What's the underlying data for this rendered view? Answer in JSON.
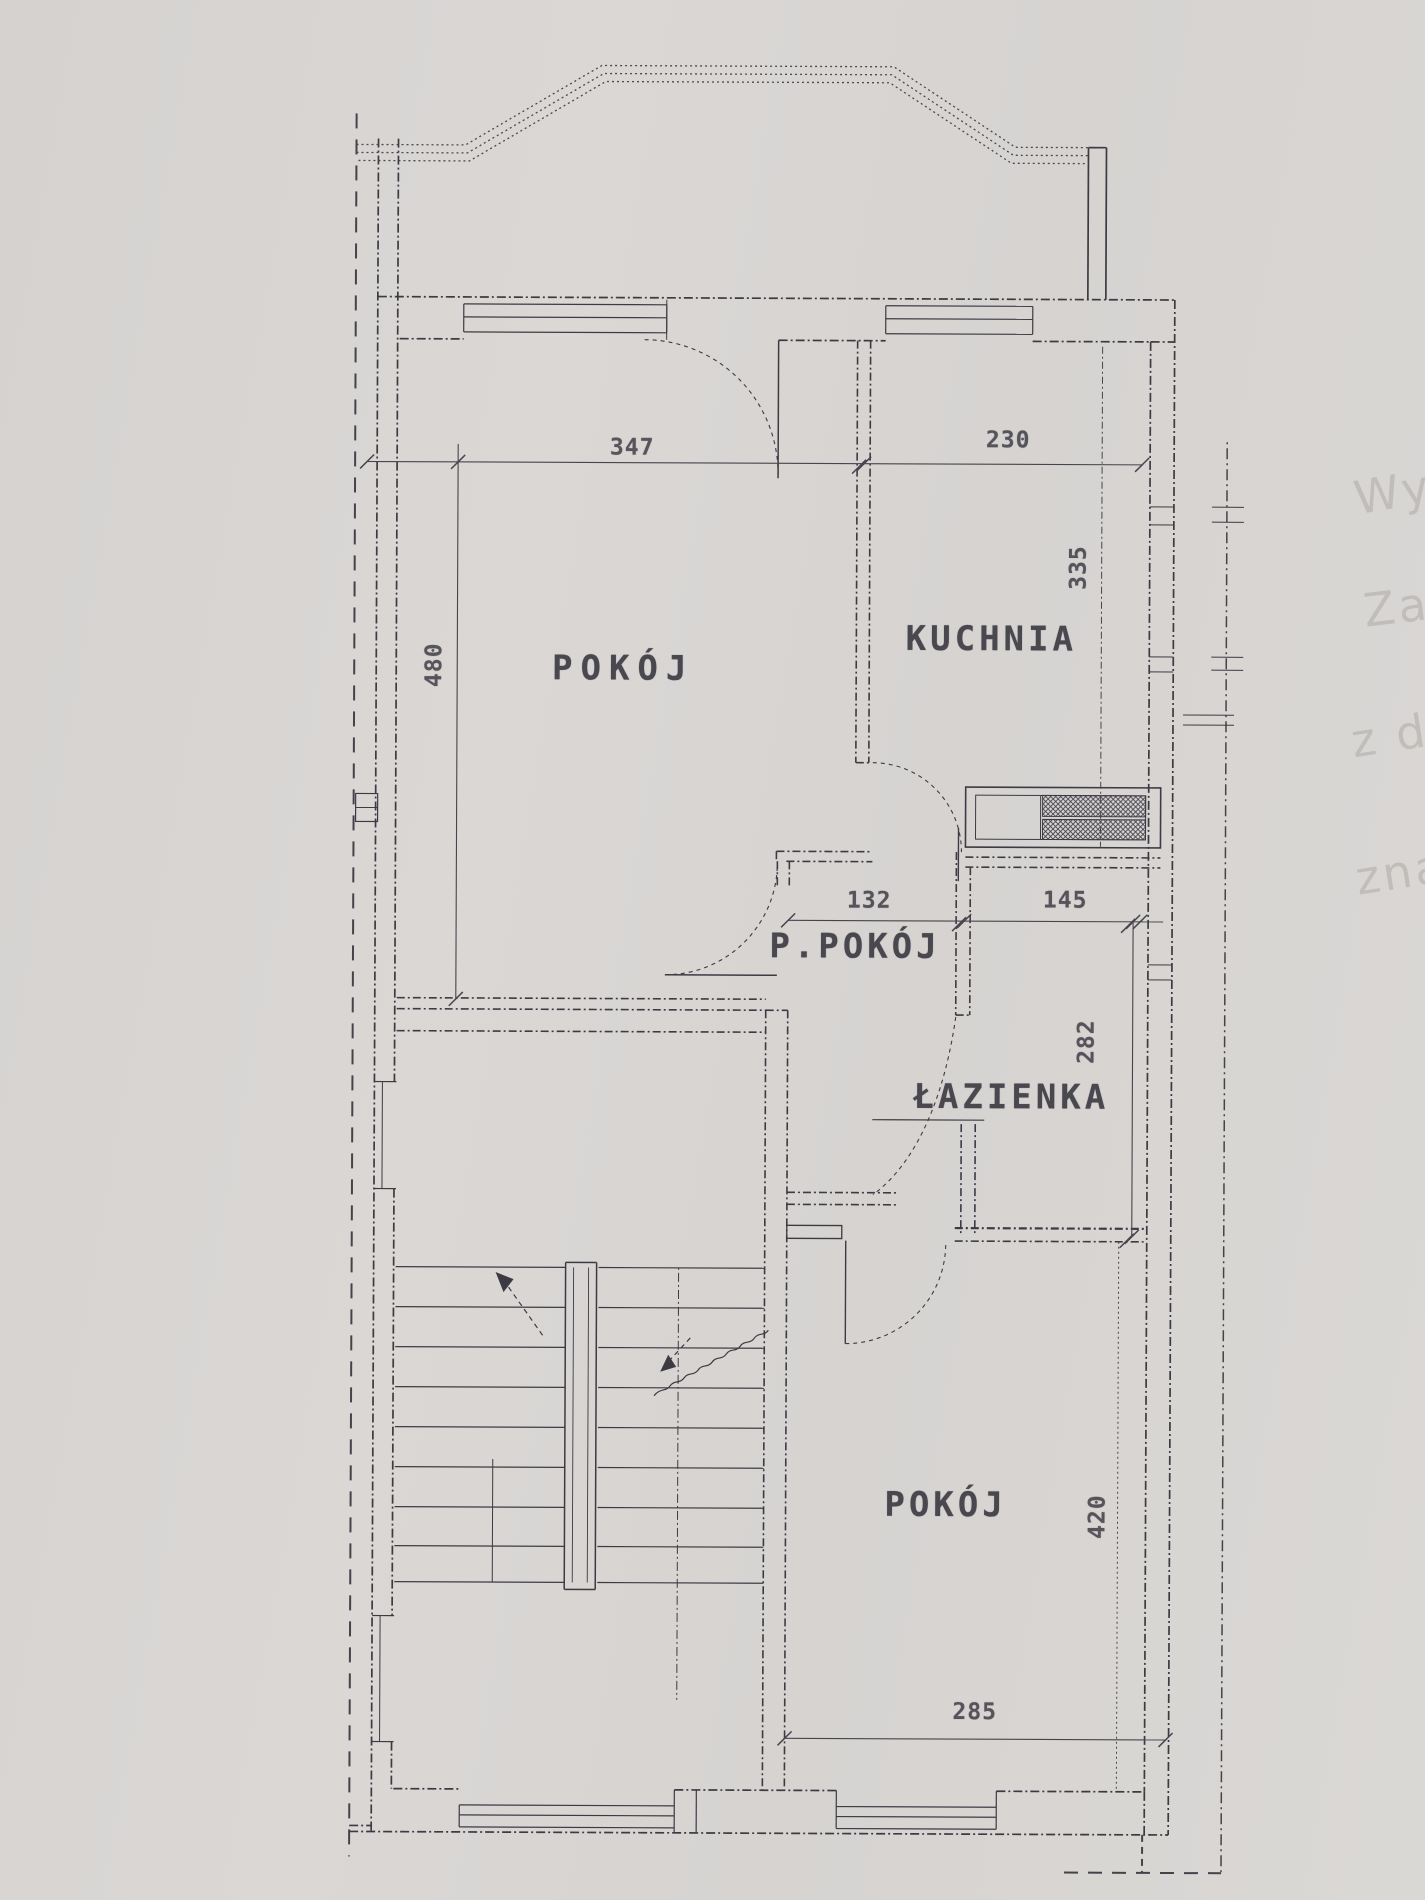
{
  "document": {
    "kind": "scanned apartment floor plan",
    "language": "Polish",
    "paper_color": "#d8d5d2",
    "ink_color": "#3c3b43",
    "ghost_ink_color": "#b2aeaa"
  },
  "rooms": [
    {
      "id": "pokoj-upper",
      "label": "POKÓJ",
      "width_cm": "347",
      "depth_cm": "480"
    },
    {
      "id": "kuchnia",
      "label": "KUCHNIA",
      "width_cm": "230",
      "depth_cm": "335"
    },
    {
      "id": "p-pokoj",
      "label": "P.POKÓJ",
      "width_cm": "132"
    },
    {
      "id": "lazienka",
      "label": "ŁAZIENKA",
      "width_cm": "145",
      "depth_cm": "282"
    },
    {
      "id": "pokoj-lower",
      "label": "POKÓJ",
      "width_cm": "285",
      "depth_cm": "420"
    }
  ],
  "dimensions": [
    {
      "id": "dim-347",
      "value": "347",
      "orientation": "horizontal"
    },
    {
      "id": "dim-230",
      "value": "230",
      "orientation": "horizontal"
    },
    {
      "id": "dim-480",
      "value": "480",
      "orientation": "vertical"
    },
    {
      "id": "dim-335",
      "value": "335",
      "orientation": "vertical"
    },
    {
      "id": "dim-132",
      "value": "132",
      "orientation": "horizontal"
    },
    {
      "id": "dim-145",
      "value": "145",
      "orientation": "horizontal"
    },
    {
      "id": "dim-282",
      "value": "282",
      "orientation": "vertical"
    },
    {
      "id": "dim-420",
      "value": "420",
      "orientation": "vertical"
    },
    {
      "id": "dim-285",
      "value": "285",
      "orientation": "horizontal"
    }
  ],
  "ghost_texts": [
    {
      "text": "Wy"
    },
    {
      "text": "Zał"
    },
    {
      "text": "z dr"
    },
    {
      "text": "zna"
    }
  ]
}
